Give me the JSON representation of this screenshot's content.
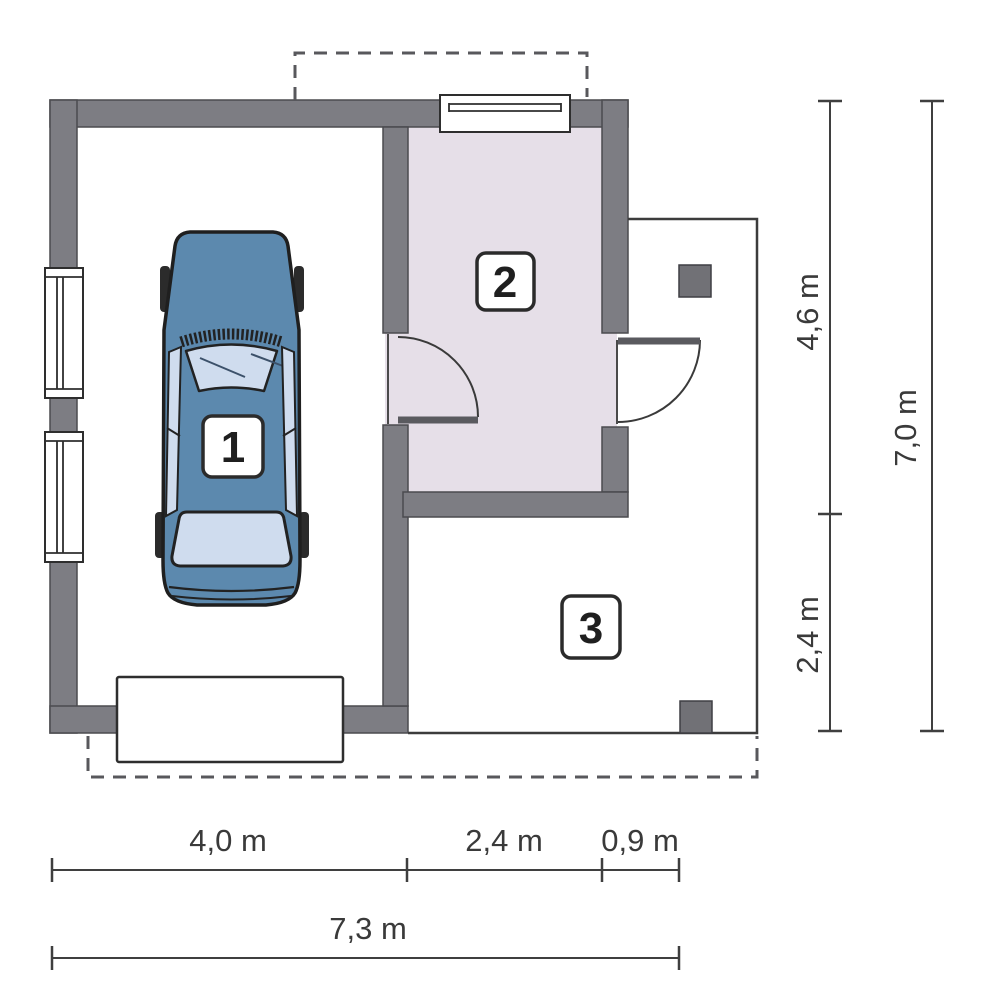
{
  "rooms": [
    {
      "number": "1"
    },
    {
      "number": "2"
    },
    {
      "number": "3"
    }
  ],
  "dimensions": {
    "bottom_segments": [
      {
        "label": "4,0 m"
      },
      {
        "label": "2,4 m"
      },
      {
        "label": "0,9 m"
      }
    ],
    "bottom_total": "7,3 m",
    "right_segments": [
      {
        "label": "4,6 m"
      },
      {
        "label": "2,4 m"
      }
    ],
    "right_total": "7,0 m"
  },
  "colors": {
    "wall": "#7d7d83",
    "room2_floor": "#e6dfe8",
    "car_body": "#5c89ae",
    "car_glass": "#cfdcee",
    "pillar": "#717176",
    "outline": "#2e2e2e",
    "dimension_text": "#3a3a3a"
  }
}
